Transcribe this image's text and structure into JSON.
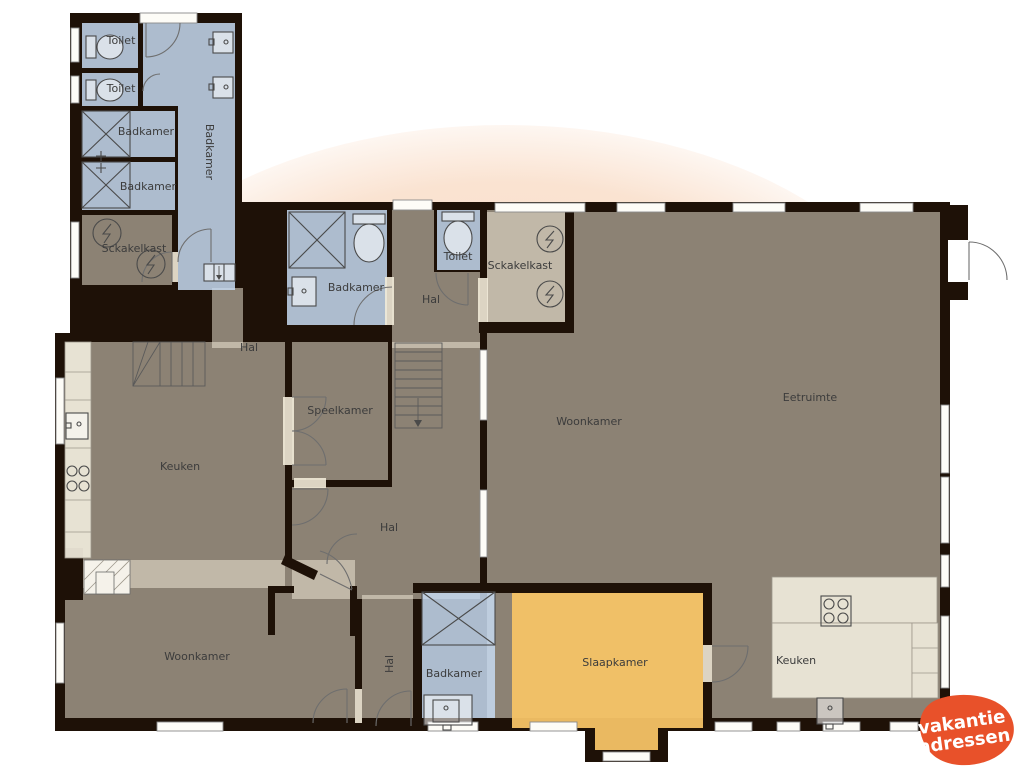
{
  "watermark": {
    "line1": "vakantie",
    "line2": "adressen"
  },
  "logo": {
    "line1": "vakantie",
    "line2": "adressen"
  },
  "colors": {
    "wall": "#1e1107",
    "floor": "#f1ead8",
    "wet_room": "#c7dbf1",
    "bedroom": "#f6c366",
    "watermark_blob": "#f9dcc6",
    "logo_orange": "#e8512a"
  },
  "rooms": [
    {
      "id": "toilet-wing-1",
      "label": "Toilet"
    },
    {
      "id": "toilet-wing-2",
      "label": "Toilet"
    },
    {
      "id": "badkamer-wing-a",
      "label": "Badkamer"
    },
    {
      "id": "badkamer-wing-b",
      "label": "Badkamer"
    },
    {
      "id": "badkamer-wing-corridor",
      "label": "Badkamer"
    },
    {
      "id": "schakelkast-wing",
      "label": "Sckakelkast"
    },
    {
      "id": "badkamer-top",
      "label": "Badkamer"
    },
    {
      "id": "hal-top",
      "label": "Hal"
    },
    {
      "id": "toilet-top",
      "label": "Toilet"
    },
    {
      "id": "schakelkast-top",
      "label": "Sckakelkast"
    },
    {
      "id": "hal-junction",
      "label": "Hal"
    },
    {
      "id": "speelkamer",
      "label": "Speelkamer"
    },
    {
      "id": "hal-center",
      "label": "Hal"
    },
    {
      "id": "keuken-left",
      "label": "Keuken"
    },
    {
      "id": "woonkamer-center",
      "label": "Woonkamer"
    },
    {
      "id": "eetruimte",
      "label": "Eetruimte"
    },
    {
      "id": "woonkamer-bottom",
      "label": "Woonkamer"
    },
    {
      "id": "hal-bottom",
      "label": "Hal"
    },
    {
      "id": "badkamer-bottom",
      "label": "Badkamer"
    },
    {
      "id": "slaapkamer",
      "label": "Slaapkamer"
    },
    {
      "id": "keuken-right",
      "label": "Keuken"
    }
  ]
}
